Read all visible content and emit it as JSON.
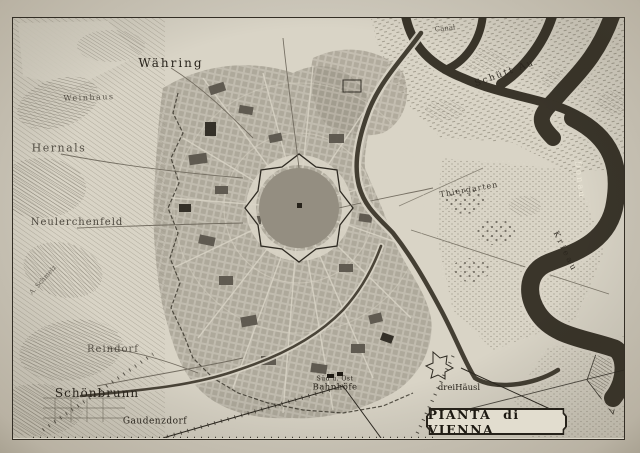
{
  "map": {
    "cartouche_title": "PIANTA di VIENNA",
    "places": {
      "waehring": "Währing",
      "weinhaus": "Weinhaus",
      "hernals": "Hernals",
      "neulerchenfeld": "Neulerchenfeld",
      "schmelz": "A. Schmelz",
      "reindorf": "Reindorf",
      "schoenbrunn": "Schönbrunn",
      "gaudenzdorf": "Gaudenzdorf",
      "station_line1": "Süd u. Ost",
      "station_line2": "Bahnhöfe",
      "dreihaeusl": "dreiHäusl",
      "thiergarten": "Thiergarten",
      "schuettau": "Schütt Au",
      "krieau": "Krieau",
      "canal": "Canal",
      "donau": "Donau"
    },
    "colors": {
      "paper": "#d9d4c6",
      "margin": "#c6c1b4",
      "ink": "#29241c",
      "river": "#3a352a",
      "city_block": "#5b564d"
    }
  }
}
